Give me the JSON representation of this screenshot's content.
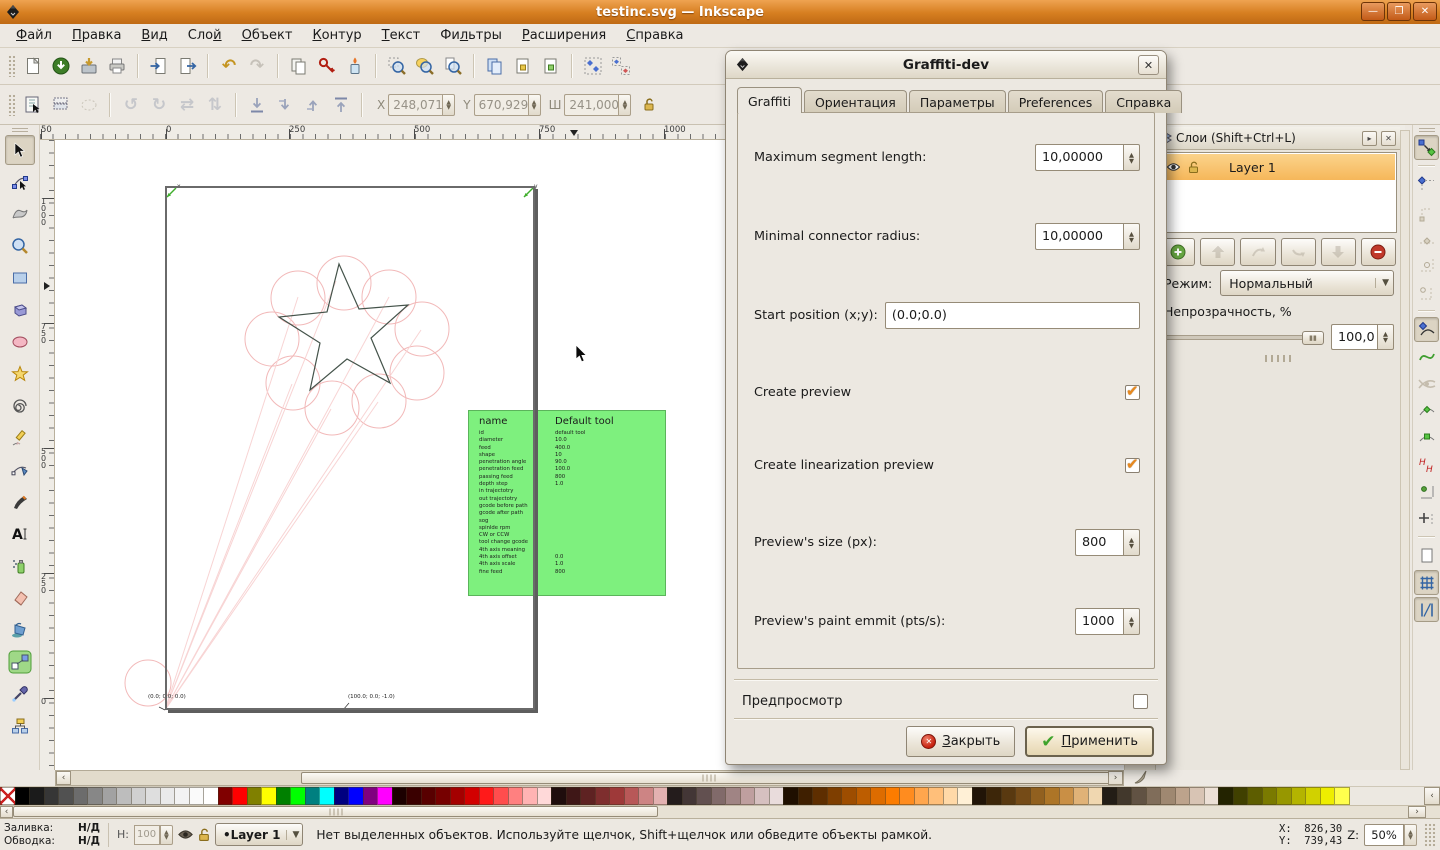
{
  "window": {
    "title": "testinc.svg — Inkscape",
    "minimize": "—",
    "maximize": "❐",
    "close": "✕"
  },
  "menu": [
    {
      "pre": "",
      "acc": "Ф",
      "post": "айл"
    },
    {
      "pre": "",
      "acc": "П",
      "post": "равка"
    },
    {
      "pre": "",
      "acc": "В",
      "post": "ид"
    },
    {
      "pre": "Сло",
      "acc": "й",
      "post": ""
    },
    {
      "pre": "",
      "acc": "О",
      "post": "бъект"
    },
    {
      "pre": "",
      "acc": "К",
      "post": "онтур"
    },
    {
      "pre": "",
      "acc": "Т",
      "post": "екст"
    },
    {
      "pre": "Фи",
      "acc": "л",
      "post": "ьтры"
    },
    {
      "pre": "",
      "acc": "Р",
      "post": "асширения"
    },
    {
      "pre": "",
      "acc": "С",
      "post": "правка"
    }
  ],
  "icons": {
    "toolbar_main": [
      "new-document",
      "open",
      "save",
      "print",
      "import",
      "export",
      "undo",
      "redo",
      "copy",
      "paste",
      "paste-style",
      "zoom-selection",
      "zoom-drawing",
      "zoom-page",
      "duplicate",
      "clone",
      "unlink-clone",
      "group",
      "ungroup"
    ],
    "toolbar_select": [
      "select-all",
      "select-all-layers",
      "deselect",
      "rotate-ccw",
      "rotate-cw",
      "flip-horizontal",
      "flip-vertical",
      "lower-to-bottom",
      "lower",
      "raise",
      "raise-to-top",
      "lock-ratio"
    ],
    "toolbox": [
      "selector",
      "node-editor",
      "tweak",
      "zoom",
      "rectangle",
      "3d-box",
      "ellipse",
      "star",
      "spiral",
      "pencil",
      "bezier-pen",
      "calligraphy",
      "text",
      "spray",
      "eraser",
      "paint-bucket",
      "gradient",
      "dropper",
      "connector"
    ],
    "snapbar": [
      "snap-enable",
      "snap-bbox",
      "snap-bbox-corner",
      "snap-bbox-edge",
      "snap-bbox-midpoint",
      "snap-bbox-center",
      "snap-nodes",
      "snap-path",
      "snap-intersection",
      "snap-cusp-node",
      "snap-smooth-node",
      "snap-text",
      "snap-rotation-center",
      "snap-others",
      "snap-page-border",
      "snap-grid",
      "snap-guides"
    ],
    "layer_buttons": [
      "add-layer",
      "raise-layer-top",
      "raise-layer",
      "lower-layer",
      "lower-layer-bottom",
      "delete-layer"
    ]
  },
  "toolbar_xy": {
    "x_label": "X",
    "x": "248,071",
    "y_label": "Y",
    "y": "670,929",
    "w_label": "Ш",
    "w": "241,000"
  },
  "rulers": {
    "top": [
      {
        "t": "50",
        "px": "1px"
      },
      {
        "t": "0",
        "px": "126px"
      },
      {
        "t": "250",
        "px": "249px"
      },
      {
        "t": "500",
        "px": "374px"
      },
      {
        "t": "750",
        "px": "499px"
      },
      {
        "t": "1000",
        "px": "624px"
      }
    ],
    "left": [
      {
        "t": "1000",
        "px": "58px"
      },
      {
        "t": "750",
        "px": "183px"
      },
      {
        "t": "500",
        "px": "308px"
      },
      {
        "t": "250",
        "px": "433px"
      },
      {
        "t": "0",
        "px": "558px"
      }
    ]
  },
  "canvas": {
    "axis_x": "x",
    "axis_y": "y",
    "origin_label": "(0.0; 0.0; 0.0)",
    "second_label": "(100.0; 0.0; -1.0)"
  },
  "tool_table": {
    "name_header": "name",
    "value_header": "Default tool",
    "rows": [
      {
        "k": "id",
        "v": "default tool"
      },
      {
        "k": "diameter",
        "v": "10.0"
      },
      {
        "k": "feed",
        "v": "400.0"
      },
      {
        "k": "shape",
        "v": "10"
      },
      {
        "k": "penetration angle",
        "v": "90.0"
      },
      {
        "k": "penetration feed",
        "v": "100.0"
      },
      {
        "k": "passing feed",
        "v": "800"
      },
      {
        "k": "depth step",
        "v": "1.0"
      },
      {
        "k": "in trajectotry",
        "v": ""
      },
      {
        "k": "out trajectotry",
        "v": ""
      },
      {
        "k": "gcode before path",
        "v": ""
      },
      {
        "k": "gcode after path",
        "v": ""
      },
      {
        "k": "sog",
        "v": ""
      },
      {
        "k": "spinlde rpm",
        "v": ""
      },
      {
        "k": "CW or CCW",
        "v": ""
      },
      {
        "k": "tool change gcode",
        "v": ""
      },
      {
        "k": "4th axis meaning",
        "v": ""
      },
      {
        "k": "4th axis offset",
        "v": "0.0"
      },
      {
        "k": "4th axis scale",
        "v": "1.0"
      },
      {
        "k": "fine feed",
        "v": "800"
      }
    ]
  },
  "dialog": {
    "title": "Graffiti-dev",
    "close_glyph": "✕",
    "tabs": [
      {
        "label": "Graffiti",
        "active": true
      },
      {
        "label": "Ориентация",
        "active": false
      },
      {
        "label": "Параметры",
        "active": false
      },
      {
        "label": "Preferences",
        "active": false
      },
      {
        "label": "Справка",
        "active": false
      }
    ],
    "fields": {
      "max_segment": {
        "label": "Maximum segment length:",
        "value": "10,00000"
      },
      "min_radius": {
        "label": "Minimal connector radius:",
        "value": "10,00000"
      },
      "start_pos": {
        "label": "Start position (x;y):",
        "value": "(0.0;0.0)"
      },
      "create_preview": {
        "label": "Create preview",
        "checked": true
      },
      "create_lin_preview": {
        "label": "Create linearization preview",
        "checked": true
      },
      "preview_size": {
        "label": "Preview's size (px):",
        "value": "800"
      },
      "preview_emit": {
        "label": "Preview's paint emmit (pts/s):",
        "value": "1000"
      }
    },
    "preview_label": "Предпросмотр",
    "buttons": {
      "close": {
        "pre": "",
        "acc": "З",
        "post": "акрыть"
      },
      "apply": {
        "pre": "",
        "acc": "П",
        "post": "рименить"
      }
    }
  },
  "layers_panel": {
    "title": "Слои (Shift+Ctrl+L)",
    "layer_name": "Layer 1",
    "mode_label": "Режим:",
    "mode_value": "Нормальный",
    "opacity_label": "Непрозрачность, %",
    "opacity_value": "100,0"
  },
  "palette": {
    "swatches": [
      {
        "c": "none",
        "x": true
      },
      {
        "c": "#000000"
      },
      {
        "c": "#1b1b1b"
      },
      {
        "c": "#363636"
      },
      {
        "c": "#515151"
      },
      {
        "c": "#6c6c6c"
      },
      {
        "c": "#878787"
      },
      {
        "c": "#a2a2a2"
      },
      {
        "c": "#bdbdbd"
      },
      {
        "c": "#d0d0d0"
      },
      {
        "c": "#dedede"
      },
      {
        "c": "#eaeaea"
      },
      {
        "c": "#f3f3f3"
      },
      {
        "c": "#fafafa"
      },
      {
        "c": "#ffffff"
      },
      {
        "c": "#800000"
      },
      {
        "c": "#ff0000"
      },
      {
        "c": "#808000"
      },
      {
        "c": "#ffff00"
      },
      {
        "c": "#008000"
      },
      {
        "c": "#00ff00"
      },
      {
        "c": "#008080"
      },
      {
        "c": "#00ffff"
      },
      {
        "c": "#000080"
      },
      {
        "c": "#0000ff"
      },
      {
        "c": "#800080"
      },
      {
        "c": "#ff00ff"
      },
      {
        "c": "#1c0000"
      },
      {
        "c": "#3a0000"
      },
      {
        "c": "#580000"
      },
      {
        "c": "#760000"
      },
      {
        "c": "#a40000"
      },
      {
        "c": "#d20000"
      },
      {
        "c": "#ff1a1a"
      },
      {
        "c": "#ff4d4d"
      },
      {
        "c": "#ff8080"
      },
      {
        "c": "#ffb3b3"
      },
      {
        "c": "#ffd9d9"
      },
      {
        "c": "#1f0d0d"
      },
      {
        "c": "#3f1717"
      },
      {
        "c": "#5e2222"
      },
      {
        "c": "#7e2e2e"
      },
      {
        "c": "#9e3939"
      },
      {
        "c": "#b85858"
      },
      {
        "c": "#cd8484"
      },
      {
        "c": "#e3b1b1"
      },
      {
        "c": "#241c1c"
      },
      {
        "c": "#433636"
      },
      {
        "c": "#625050"
      },
      {
        "c": "#816a6a"
      },
      {
        "c": "#a08484"
      },
      {
        "c": "#bf9f9f"
      },
      {
        "c": "#d6c0c0"
      },
      {
        "c": "#e9dcdc"
      },
      {
        "c": "#1f0f00"
      },
      {
        "c": "#3f1f00"
      },
      {
        "c": "#5e2e00"
      },
      {
        "c": "#7e3e00"
      },
      {
        "c": "#9e4d00"
      },
      {
        "c": "#bd5d00"
      },
      {
        "c": "#dd6c00"
      },
      {
        "c": "#fc7c00"
      },
      {
        "c": "#ff8c1f"
      },
      {
        "c": "#ffa64d"
      },
      {
        "c": "#ffbf7a"
      },
      {
        "c": "#ffd9a8"
      },
      {
        "c": "#fff0d6"
      },
      {
        "c": "#211407"
      },
      {
        "c": "#3d2609"
      },
      {
        "c": "#593910"
      },
      {
        "c": "#754b17"
      },
      {
        "c": "#91601f"
      },
      {
        "c": "#ad7527"
      },
      {
        "c": "#c98f45"
      },
      {
        "c": "#e0b277"
      },
      {
        "c": "#f0d7b0"
      },
      {
        "c": "#231d16"
      },
      {
        "c": "#42382c"
      },
      {
        "c": "#615243"
      },
      {
        "c": "#806d5a"
      },
      {
        "c": "#9f8871"
      },
      {
        "c": "#bda38c"
      },
      {
        "c": "#d8c4b4"
      },
      {
        "c": "#ece0d6"
      },
      {
        "c": "#232300"
      },
      {
        "c": "#404000"
      },
      {
        "c": "#5d5d00"
      },
      {
        "c": "#7a7a00"
      },
      {
        "c": "#979700"
      },
      {
        "c": "#b4b400"
      },
      {
        "c": "#d1d100"
      },
      {
        "c": "#eeee00"
      },
      {
        "c": "#ffff4d"
      }
    ]
  },
  "status": {
    "fill_label": "Заливка:",
    "fill_value": "Н/Д",
    "stroke_label": "Обводка:",
    "stroke_value": "Н/Д",
    "o_label": "Н:",
    "o_value": "100",
    "layer_bullet": "•",
    "layer_value": "Layer 1",
    "message": "Нет выделенных объектов. Используйте щелчок, Shift+щелчок или обведите объекты рамкой.",
    "xy": "X:  826,30\nY:  739,43",
    "z_label": "Z:",
    "zoom": "50%"
  }
}
